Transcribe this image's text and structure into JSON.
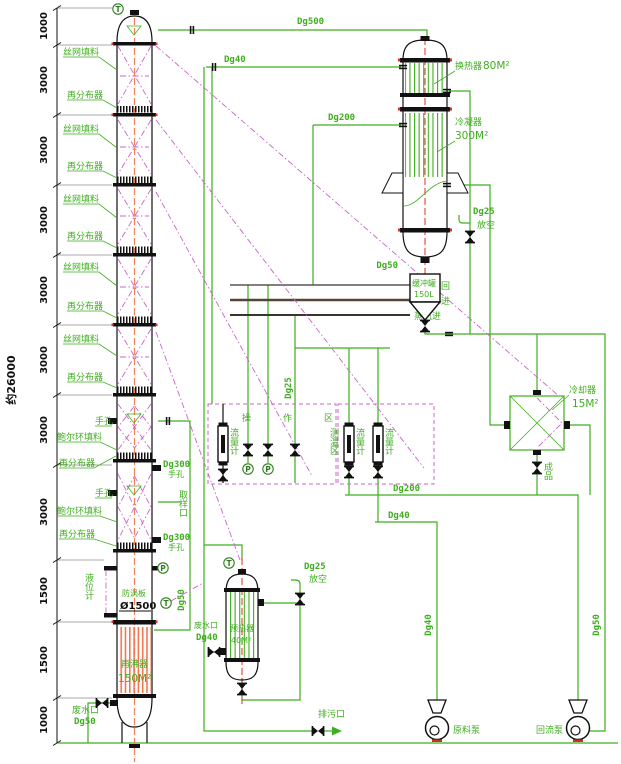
{
  "dimensions": {
    "total": "约26000",
    "segments": [
      "1000",
      "3000",
      "3000",
      "3000",
      "3000",
      "3000",
      "3000",
      "3000",
      "1500",
      "1500",
      "1000"
    ]
  },
  "column": {
    "mesh_packing": "丝网填料",
    "redistributor": "再分布器",
    "pall_packing": "鲍尔环填料",
    "handhole": "手孔",
    "handhole_dg": "Dg300",
    "level_gauge": "液位计",
    "vortex_plate": "防涡板",
    "diameter": "Ø1500",
    "reboiler": "再沸器",
    "reboiler_area": "150M²",
    "waste_port": "废水口",
    "waste_dg": "Dg50",
    "sample_port": "取样口"
  },
  "exchanger": {
    "heater": "换热器",
    "heater_area": "80M²",
    "condenser": "冷凝器",
    "condenser_area": "300M²",
    "outlet_dg": "Dg50"
  },
  "buffer": {
    "name": "缓冲罐",
    "volume": "150L"
  },
  "cooler": {
    "name": "冷却器",
    "area": "15M²",
    "product": "成品"
  },
  "preheater": {
    "name": "预热器",
    "area": "40M²",
    "waste_port": "废水口",
    "waste_dg": "Dg40"
  },
  "pipes": {
    "dg500": "Dg500",
    "dg40": "Dg40",
    "dg200": "Dg200",
    "dg300": "Dg300",
    "dg50": "Dg50",
    "dg25": "Dg25",
    "vent": "放空"
  },
  "utility": {
    "cooling_return": "冷却水回",
    "cooling_supply": "冷却水进",
    "steam": "蒸汽进"
  },
  "zones": {
    "operation": "操作区",
    "temperature": "测温区",
    "flow_meter": "流量计"
  },
  "bottom": {
    "drain": "排污口",
    "feed_pump": "原料泵",
    "reflux_pump": "回流泵"
  },
  "instruments": {
    "temp": "T",
    "press": "P"
  }
}
